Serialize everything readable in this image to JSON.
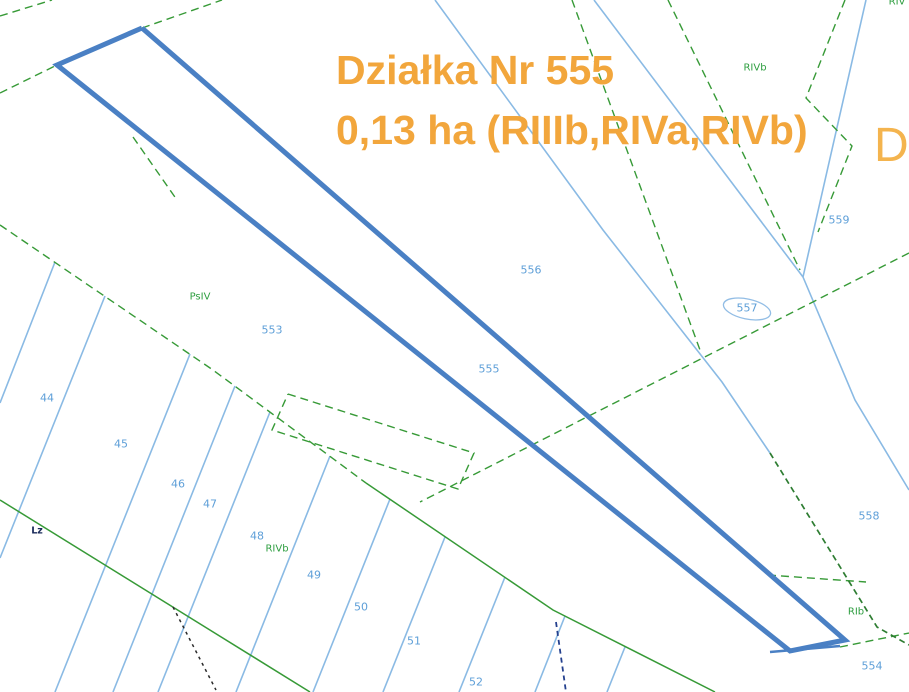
{
  "title": {
    "line1": "Działka Nr 555",
    "line2": "0,13 ha (RIIIb,RIVa,RIVb)",
    "color": "#F2A63C",
    "watermark_fragment": "D"
  },
  "map": {
    "background_color": "#FFFFFF",
    "colors": {
      "highlight_outline": "#4A80C4",
      "boundary_blue": "#8ABAE4",
      "boundary_green": "#379A37",
      "boundary_green_dark": "#2E7D32",
      "label_blue": "#5E9FD8",
      "label_green": "#2E9E40",
      "label_dark": "#1A2A5A"
    },
    "highlighted_parcel": {
      "number": "555",
      "area": "0,13 ha",
      "soil_classes": "RIIIb,RIVa,RIVb",
      "polygon": [
        [
          142,
          28
        ],
        [
          845,
          640
        ],
        [
          790,
          651
        ],
        [
          57,
          65
        ]
      ],
      "tip_double_stroke": [
        [
          770,
          652
        ],
        [
          840,
          646
        ]
      ]
    },
    "blue_lines": [
      {
        "points": [
          [
            435,
            0
          ],
          [
            603,
            230
          ],
          [
            722,
            382
          ],
          [
            770,
            453
          ]
        ]
      },
      {
        "points": [
          [
            594,
            0
          ],
          [
            803,
            277
          ]
        ]
      },
      {
        "points": [
          [
            866,
            0
          ],
          [
            803,
            277
          ]
        ]
      },
      {
        "points": [
          [
            803,
            277
          ],
          [
            855,
            400
          ],
          [
            909,
            490
          ]
        ]
      },
      {
        "points": [
          [
            55,
            262
          ],
          [
            0,
            403
          ]
        ]
      },
      {
        "points": [
          [
            105,
            296
          ],
          [
            0,
            558
          ]
        ]
      },
      {
        "points": [
          [
            190,
            354
          ],
          [
            55,
            692
          ]
        ]
      },
      {
        "points": [
          [
            235,
            386
          ],
          [
            113,
            692
          ]
        ]
      },
      {
        "points": [
          [
            270,
            412
          ],
          [
            158,
            692
          ]
        ]
      },
      {
        "points": [
          [
            330,
            456
          ],
          [
            236,
            692
          ]
        ]
      },
      {
        "points": [
          [
            390,
            499
          ],
          [
            313,
            692
          ]
        ]
      },
      {
        "points": [
          [
            445,
            537
          ],
          [
            383,
            692
          ]
        ]
      },
      {
        "points": [
          [
            505,
            577
          ],
          [
            459,
            692
          ]
        ]
      },
      {
        "points": [
          [
            565,
            616
          ],
          [
            535,
            692
          ]
        ]
      },
      {
        "points": [
          [
            625,
            647
          ],
          [
            607,
            692
          ]
        ]
      }
    ],
    "green_dashed_lines": [
      {
        "points": [
          [
            0,
            16
          ],
          [
            52,
            0
          ]
        ]
      },
      {
        "points": [
          [
            0,
            93
          ],
          [
            57,
            65
          ]
        ]
      },
      {
        "points": [
          [
            142,
            28
          ],
          [
            222,
            0
          ]
        ]
      },
      {
        "points": [
          [
            0,
            225
          ],
          [
            213,
            370
          ],
          [
            366,
            483
          ]
        ]
      },
      {
        "points": [
          [
            909,
            253
          ],
          [
            420,
            502
          ]
        ]
      },
      {
        "points": [
          [
            572,
            0
          ],
          [
            700,
            350
          ]
        ]
      },
      {
        "points": [
          [
            668,
            0
          ],
          [
            800,
            270
          ]
        ]
      },
      {
        "points": [
          [
            845,
            0
          ],
          [
            806,
            98
          ],
          [
            852,
            146
          ],
          [
            818,
            232
          ]
        ]
      },
      {
        "points": [
          [
            768,
            575
          ],
          [
            866,
            582
          ]
        ]
      },
      {
        "points": [
          [
            840,
            647
          ],
          [
            909,
            633
          ]
        ]
      },
      {
        "points": [
          [
            133,
            137
          ],
          [
            177,
            200
          ]
        ]
      },
      {
        "points": [
          [
            288,
            394
          ],
          [
            474,
            453
          ],
          [
            458,
            489
          ],
          [
            272,
            430
          ],
          [
            288,
            394
          ]
        ]
      }
    ],
    "green_solid_lines": [
      {
        "points": [
          [
            366,
            483
          ],
          [
            553,
            610
          ],
          [
            715,
            692
          ]
        ]
      },
      {
        "points": [
          [
            0,
            500
          ],
          [
            310,
            692
          ]
        ]
      }
    ],
    "green_dark_dashed_lines": [
      {
        "points": [
          [
            770,
            453
          ],
          [
            877,
            627
          ],
          [
            909,
            645
          ]
        ]
      }
    ],
    "black_dotted_line": {
      "points": [
        [
          173,
          607
        ],
        [
          216,
          690
        ]
      ]
    },
    "navy_dashed_line": {
      "points": [
        [
          556,
          622
        ],
        [
          566,
          692
        ]
      ]
    },
    "label_oval": {
      "cx": 747,
      "cy": 309,
      "rx": 24,
      "ry": 10,
      "rotate": 12
    },
    "labels": [
      {
        "text": "44",
        "x": 47,
        "y": 398,
        "kind": "parcel"
      },
      {
        "text": "45",
        "x": 121,
        "y": 444,
        "kind": "parcel"
      },
      {
        "text": "46",
        "x": 178,
        "y": 484,
        "kind": "parcel"
      },
      {
        "text": "47",
        "x": 210,
        "y": 504,
        "kind": "parcel"
      },
      {
        "text": "48",
        "x": 257,
        "y": 536,
        "kind": "parcel"
      },
      {
        "text": "49",
        "x": 314,
        "y": 575,
        "kind": "parcel"
      },
      {
        "text": "50",
        "x": 361,
        "y": 607,
        "kind": "parcel"
      },
      {
        "text": "51",
        "x": 414,
        "y": 641,
        "kind": "parcel"
      },
      {
        "text": "52",
        "x": 476,
        "y": 682,
        "kind": "parcel"
      },
      {
        "text": "553",
        "x": 272,
        "y": 330,
        "kind": "parcel"
      },
      {
        "text": "555",
        "x": 489,
        "y": 369,
        "kind": "parcel"
      },
      {
        "text": "556",
        "x": 531,
        "y": 270,
        "kind": "parcel"
      },
      {
        "text": "557",
        "x": 747,
        "y": 308,
        "kind": "parcel"
      },
      {
        "text": "558",
        "x": 869,
        "y": 516,
        "kind": "parcel"
      },
      {
        "text": "559",
        "x": 839,
        "y": 220,
        "kind": "parcel"
      },
      {
        "text": "554",
        "x": 872,
        "y": 666,
        "kind": "parcel"
      },
      {
        "text": "RIVb",
        "x": 755,
        "y": 68,
        "kind": "soil"
      },
      {
        "text": "PsIV",
        "x": 200,
        "y": 297,
        "kind": "soil"
      },
      {
        "text": "RIVb",
        "x": 277,
        "y": 549,
        "kind": "soil"
      },
      {
        "text": "RIb",
        "x": 856,
        "y": 612,
        "kind": "soil"
      },
      {
        "text": "RIV",
        "x": 897,
        "y": 2,
        "kind": "soil"
      },
      {
        "text": "Lz",
        "x": 37,
        "y": 531,
        "kind": "landuse"
      }
    ]
  }
}
